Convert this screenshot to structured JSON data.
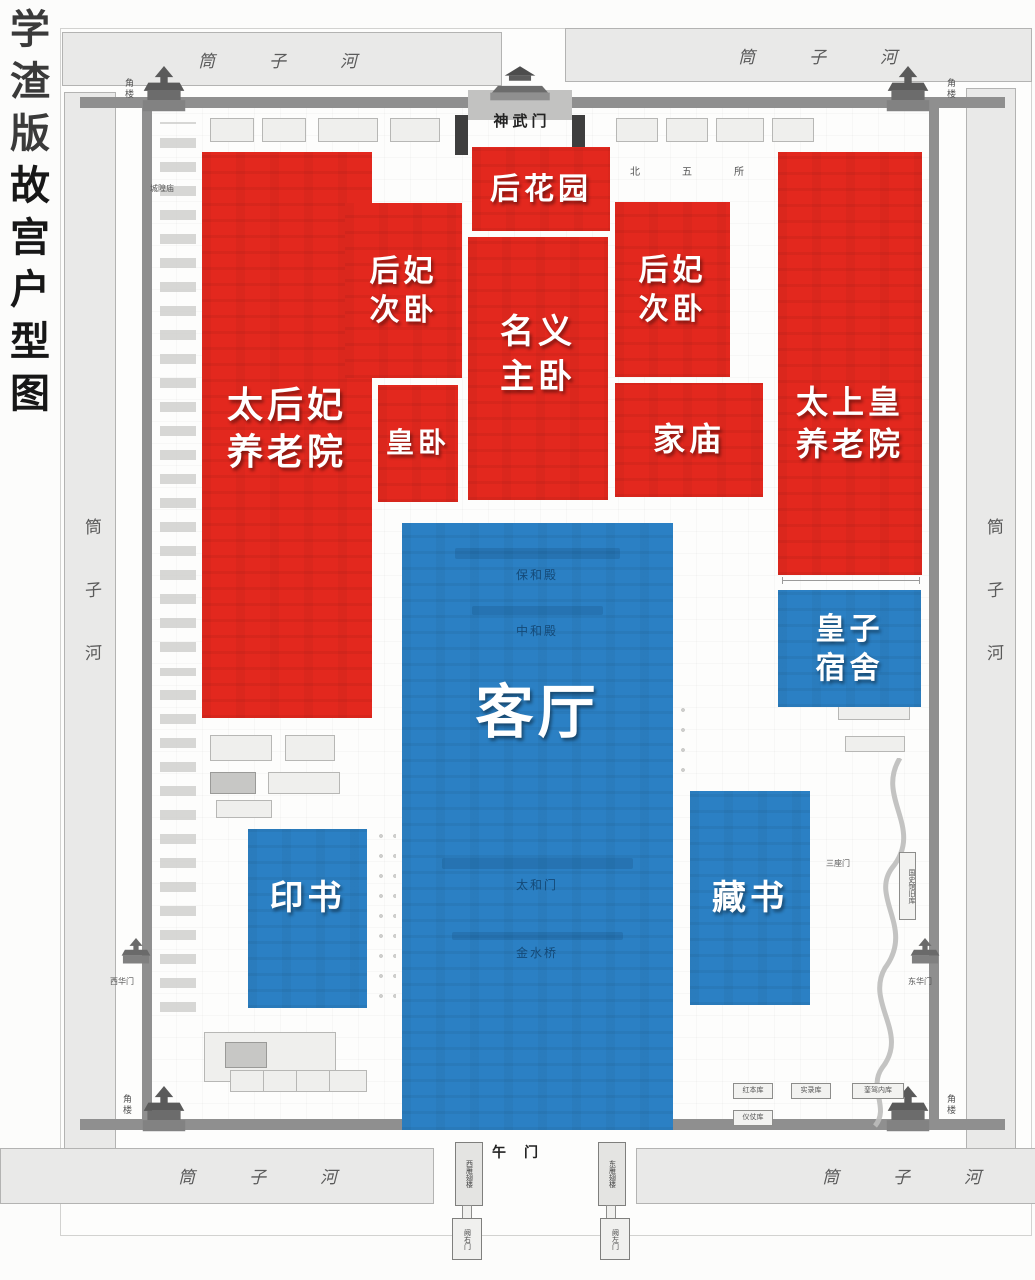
{
  "title": {
    "prefix": "学渣版",
    "main": "故宫户型图",
    "full": "学渣版故宫户型图"
  },
  "colors": {
    "red": "#e3281e",
    "blue": "#2b80c4",
    "moat_fill": "#e9e9e8",
    "wall": "#8f8f8f"
  },
  "regions": [
    {
      "id": "back-garden",
      "label": "后花园",
      "lines": [
        "后花园"
      ],
      "color": "red",
      "x": 472,
      "y": 147,
      "w": 138,
      "h": 84,
      "font_size": 30,
      "text_dy": 0
    },
    {
      "id": "dowager-nursing-home",
      "label": "太后妃养老院",
      "lines": [
        "太后妃",
        "养老院"
      ],
      "color": "red",
      "x": 202,
      "y": 152,
      "w": 170,
      "h": 566,
      "font_size": 36,
      "text_dy": -5
    },
    {
      "id": "consorts-bedroom-west",
      "label": "后妃次卧",
      "lines": [
        "后妃",
        "次卧"
      ],
      "color": "red",
      "x": 345,
      "y": 203,
      "w": 117,
      "h": 175,
      "font_size": 30,
      "text_dy": 0
    },
    {
      "id": "nominal-master-bedroom",
      "label": "名义主卧",
      "lines": [
        "名义",
        "主卧"
      ],
      "color": "red",
      "x": 468,
      "y": 237,
      "w": 140,
      "h": 263,
      "font_size": 34,
      "text_dy": -14
    },
    {
      "id": "consorts-bedroom-east",
      "label": "后妃次卧",
      "lines": [
        "后妃",
        "次卧"
      ],
      "color": "red",
      "x": 615,
      "y": 202,
      "w": 115,
      "h": 175,
      "font_size": 30,
      "text_dy": 0
    },
    {
      "id": "emperor-bedroom",
      "label": "皇卧",
      "lines": [
        "皇卧"
      ],
      "color": "red",
      "x": 378,
      "y": 385,
      "w": 80,
      "h": 117,
      "font_size": 28,
      "text_dy": 0
    },
    {
      "id": "family-temple",
      "label": "家庙",
      "lines": [
        "家庙"
      ],
      "color": "red",
      "x": 615,
      "y": 383,
      "w": 148,
      "h": 114,
      "font_size": 32,
      "text_dy": 0
    },
    {
      "id": "retired-emperor-home",
      "label": "太上皇养老院",
      "lines": [
        "太上皇",
        "养老院"
      ],
      "color": "red",
      "x": 778,
      "y": 152,
      "w": 144,
      "h": 423,
      "font_size": 32,
      "text_dy": 60
    },
    {
      "id": "living-room",
      "label": "客厅",
      "lines": [
        "客厅"
      ],
      "color": "blue",
      "x": 402,
      "y": 523,
      "w": 271,
      "h": 607,
      "font_size": 58,
      "text_dy": -114
    },
    {
      "id": "princes-dormitory",
      "label": "皇子宿舍",
      "lines": [
        "皇子",
        "宿舍"
      ],
      "color": "blue",
      "x": 778,
      "y": 590,
      "w": 143,
      "h": 117,
      "font_size": 30,
      "text_dy": 0
    },
    {
      "id": "book-printing",
      "label": "印书",
      "lines": [
        "印书"
      ],
      "color": "blue",
      "x": 248,
      "y": 829,
      "w": 119,
      "h": 179,
      "font_size": 34,
      "text_dy": -20
    },
    {
      "id": "book-collection",
      "label": "藏书",
      "lines": [
        "藏书"
      ],
      "color": "blue",
      "x": 690,
      "y": 791,
      "w": 120,
      "h": 214,
      "font_size": 34,
      "text_dy": 0
    }
  ],
  "map_labels": {
    "moat": "筒子河",
    "corner_tower": "角楼",
    "north_gate": "神武门",
    "south_gate": "午门",
    "west_wing": "西雁翅楼",
    "east_wing": "东雁翅楼",
    "west_que_gate": "阙右门",
    "east_que_gate": "阙左门",
    "west_glory_gate": "西华门",
    "east_glory_gate": "东华门",
    "city_god_temple": "城隍庙",
    "north_five_halls": "北五所",
    "three_seat_gate": "三座门",
    "history_archive": "国史馆旧库",
    "red_book_store": "红本库",
    "records_store": "实录库",
    "regalia_store": "仪仗库",
    "carriage_store": "銮驾内库",
    "baohe_hall": "保和殿",
    "zhonghe_hall": "中和殿",
    "taihe_gate": "太和门",
    "golden_water_bridge": "金水桥"
  }
}
